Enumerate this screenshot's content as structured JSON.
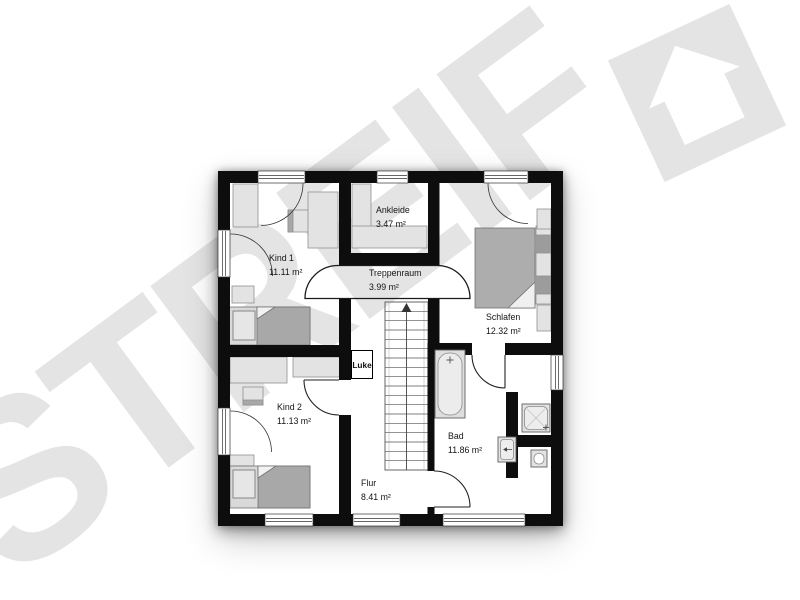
{
  "watermark": {
    "text": "STREIF",
    "color": "#e4e4e4"
  },
  "logo": {
    "icon": "tilted-square-house",
    "color": "#e4e4e4"
  },
  "rooms": {
    "kind1": {
      "name": "Kind 1",
      "area": "11.11 m²"
    },
    "ankleide": {
      "name": "Ankleide",
      "area": "3.47 m²"
    },
    "treppenraum": {
      "name": "Treppenraum",
      "area": "3.99 m²"
    },
    "schlafen": {
      "name": "Schlafen",
      "area": "12.32 m²"
    },
    "kind2": {
      "name": "Kind 2",
      "area": "11.13 m²"
    },
    "bad": {
      "name": "Bad",
      "area": "11.86 m²"
    },
    "flur": {
      "name": "Flur",
      "area": "8.41 m²"
    }
  },
  "labels": {
    "luke": "Luke"
  },
  "colors": {
    "wall": "#0d0d0d",
    "furniture_light": "#e3e3e3",
    "furniture_mid": "#b8b8b8",
    "furniture_dark": "#a0a0a0",
    "watermark": "#e4e4e4"
  }
}
